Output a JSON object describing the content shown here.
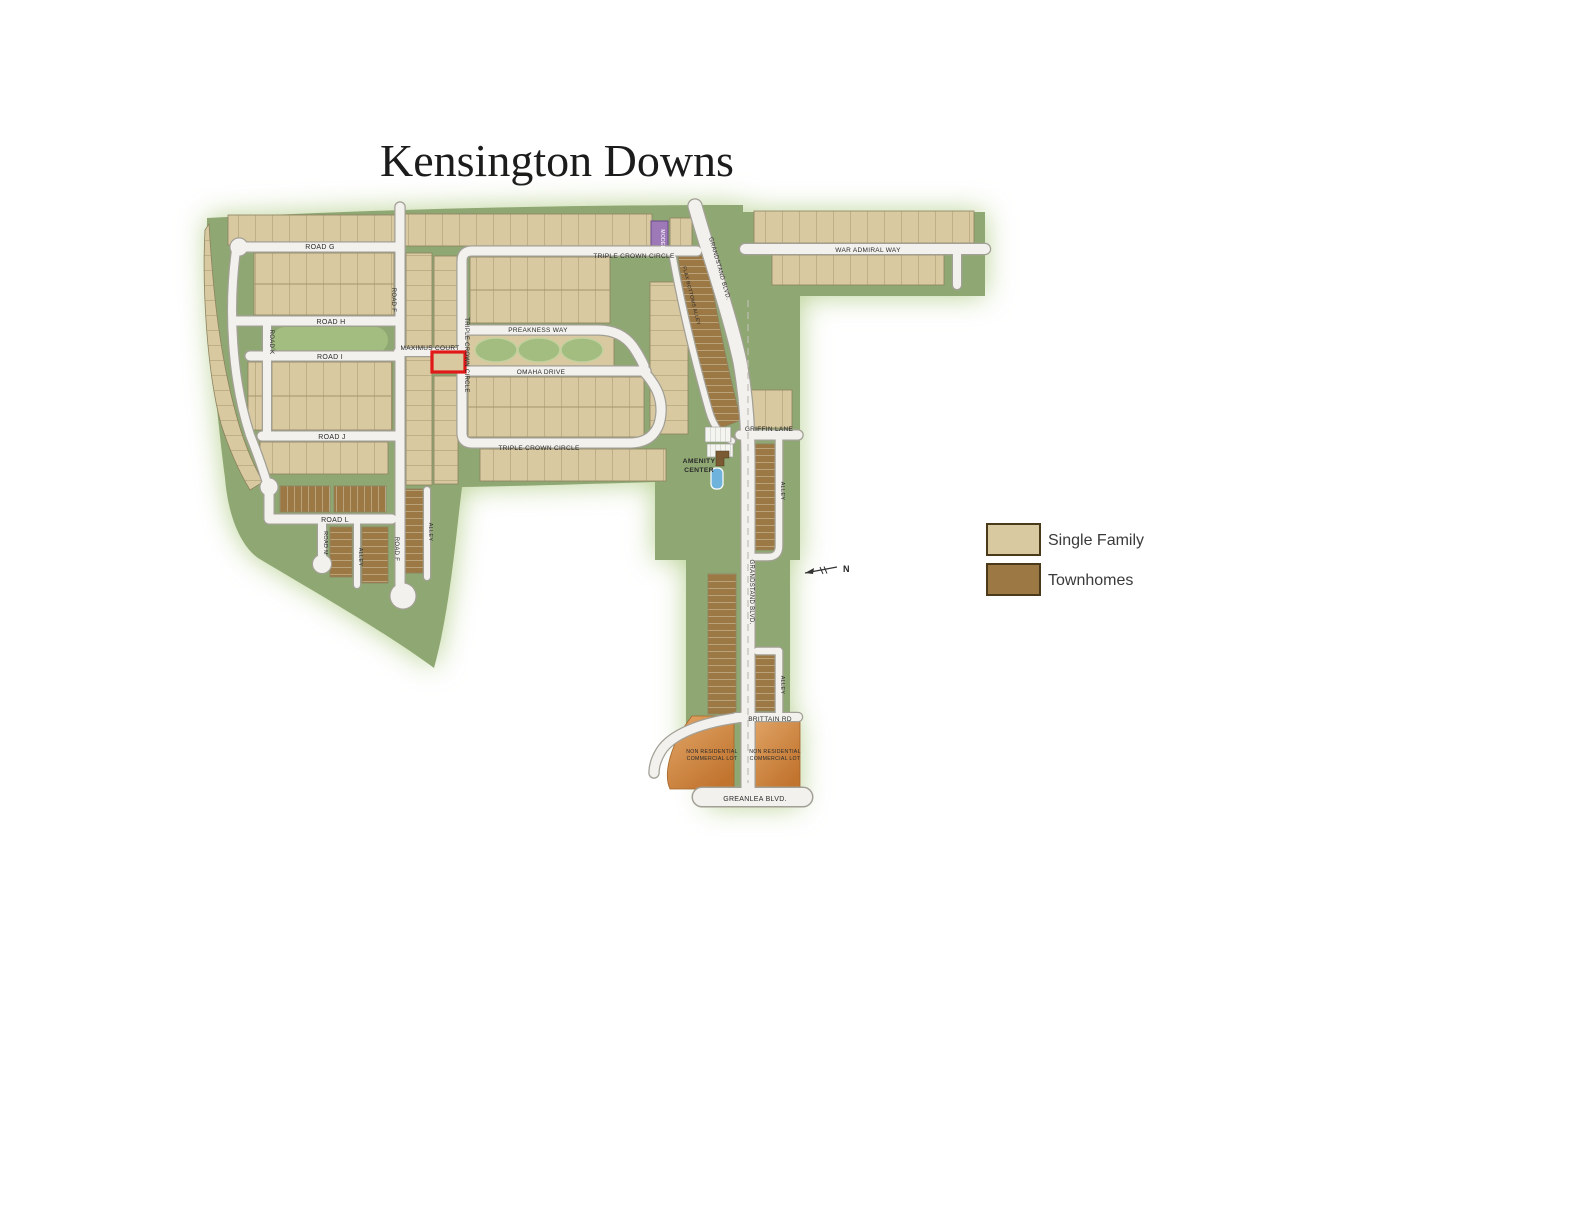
{
  "title": "Kensington Downs",
  "legend": {
    "items": [
      {
        "label": "Single Family",
        "color": "#d9c9a0"
      },
      {
        "label": "Townhomes",
        "color": "#9c7844"
      }
    ]
  },
  "north": {
    "label": "N"
  },
  "colors": {
    "map_green": "#8fa873",
    "median_green": "#a3bc80",
    "road_fill": "#f2f1ed",
    "road_casing": "#a29f95",
    "single_family": "#d9c9a0",
    "townhomes": "#9c7844",
    "commercial_orange": "#cd8540",
    "model_purple": "#9e79b8",
    "pool_blue": "#6fb3dc",
    "highlight_red": "#e01818"
  },
  "map": {
    "roads": {
      "road_g": "ROAD G",
      "road_h": "ROAD H",
      "road_i": "ROAD I",
      "road_j": "ROAD J",
      "road_k": "ROAD K",
      "road_f": "ROAD F",
      "road_l": "ROAD L",
      "road_m": "ROAD M",
      "alley": "ALLEY",
      "maximus_court": "MAXIMUS COURT",
      "triple_crown_circle": "TRIPLE CROWN CIRCLE",
      "preakness_way": "PREAKNESS WAY",
      "omaha_drive": "OMAHA DRIVE",
      "war_admiral_way": "WAR ADMIRAL WAY",
      "grandstand_blvd": "GRANDSTAND BLVD.",
      "flax_bottoms_alley": "FLAX BOTTOMS ALLEY",
      "griffin_lane": "GRIFFIN LANE",
      "brittain_rd": "BRITTAIN RD",
      "greanlea_blvd": "GREANLEA BLVD."
    },
    "labels": {
      "model": "MODEL",
      "amenity_line1": "AMENITY",
      "amenity_line2": "CENTER",
      "commercial_line1": "NON  RESIDENTIAL",
      "commercial_line2": "COMMERCIAL LOT"
    }
  }
}
